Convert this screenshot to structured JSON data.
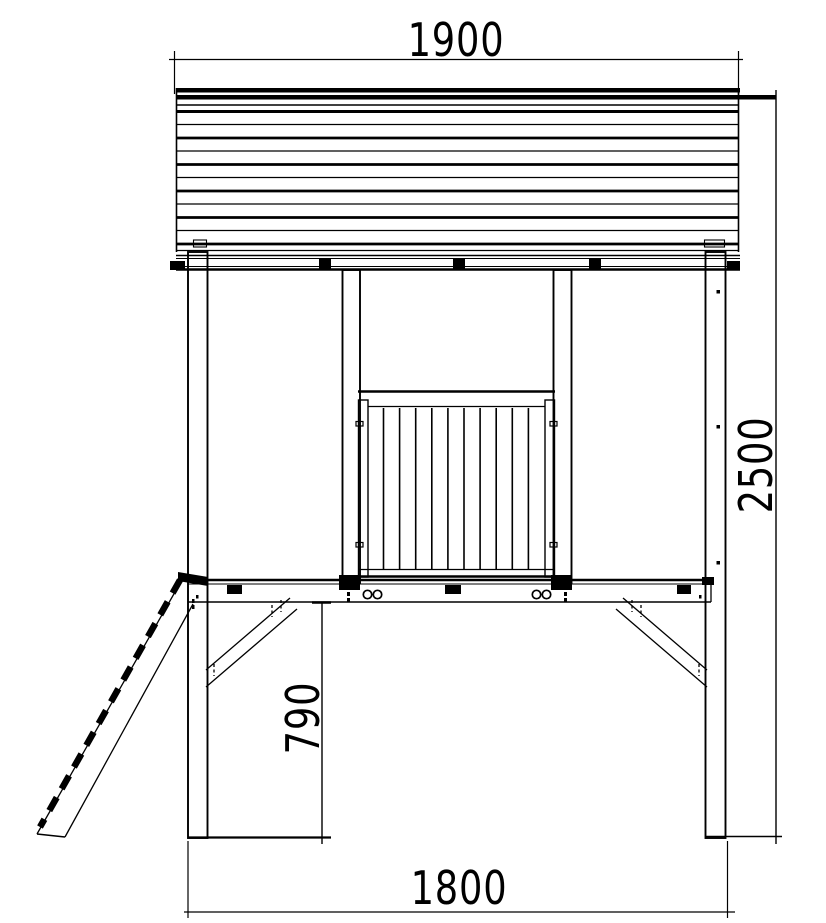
{
  "drawing": {
    "type": "technical-elevation-playhouse",
    "background_color": "#ffffff",
    "line_color": "#000000",
    "dimensions": {
      "roof_width": {
        "value": "1900",
        "orientation": "horizontal",
        "position": "top"
      },
      "total_height": {
        "value": "2500",
        "orientation": "vertical",
        "position": "right"
      },
      "platform_height": {
        "value": "790",
        "orientation": "vertical",
        "position": "center-left"
      },
      "base_width": {
        "value": "1800",
        "orientation": "horizontal",
        "position": "bottom"
      }
    }
  }
}
